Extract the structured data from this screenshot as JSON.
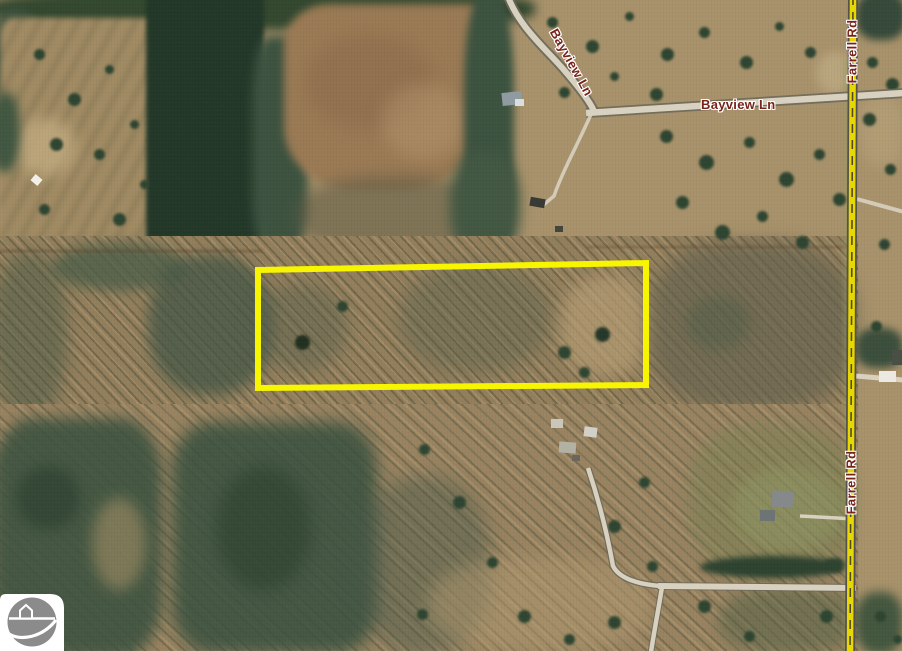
{
  "map": {
    "road_labels": [
      {
        "id": "bayview-ln-curve",
        "text": "Bayview Ln"
      },
      {
        "id": "bayview-ln-east",
        "text": "Bayview Ln"
      },
      {
        "id": "farrell-rd-north",
        "text": "Farrell Rd"
      },
      {
        "id": "farrell-rd-south",
        "text": "Farrell Rd"
      }
    ],
    "colors": {
      "parcel_outline": "#f8f500",
      "highway_yellow": "#e9d800",
      "road_surface": "#d8d1c0",
      "label_text": "#76231a",
      "label_halo": "#ffffff"
    }
  },
  "logo": {
    "icon": "house-on-road-circle-icon",
    "circle_color": "#8b8b8b",
    "background": "#ffffff"
  }
}
